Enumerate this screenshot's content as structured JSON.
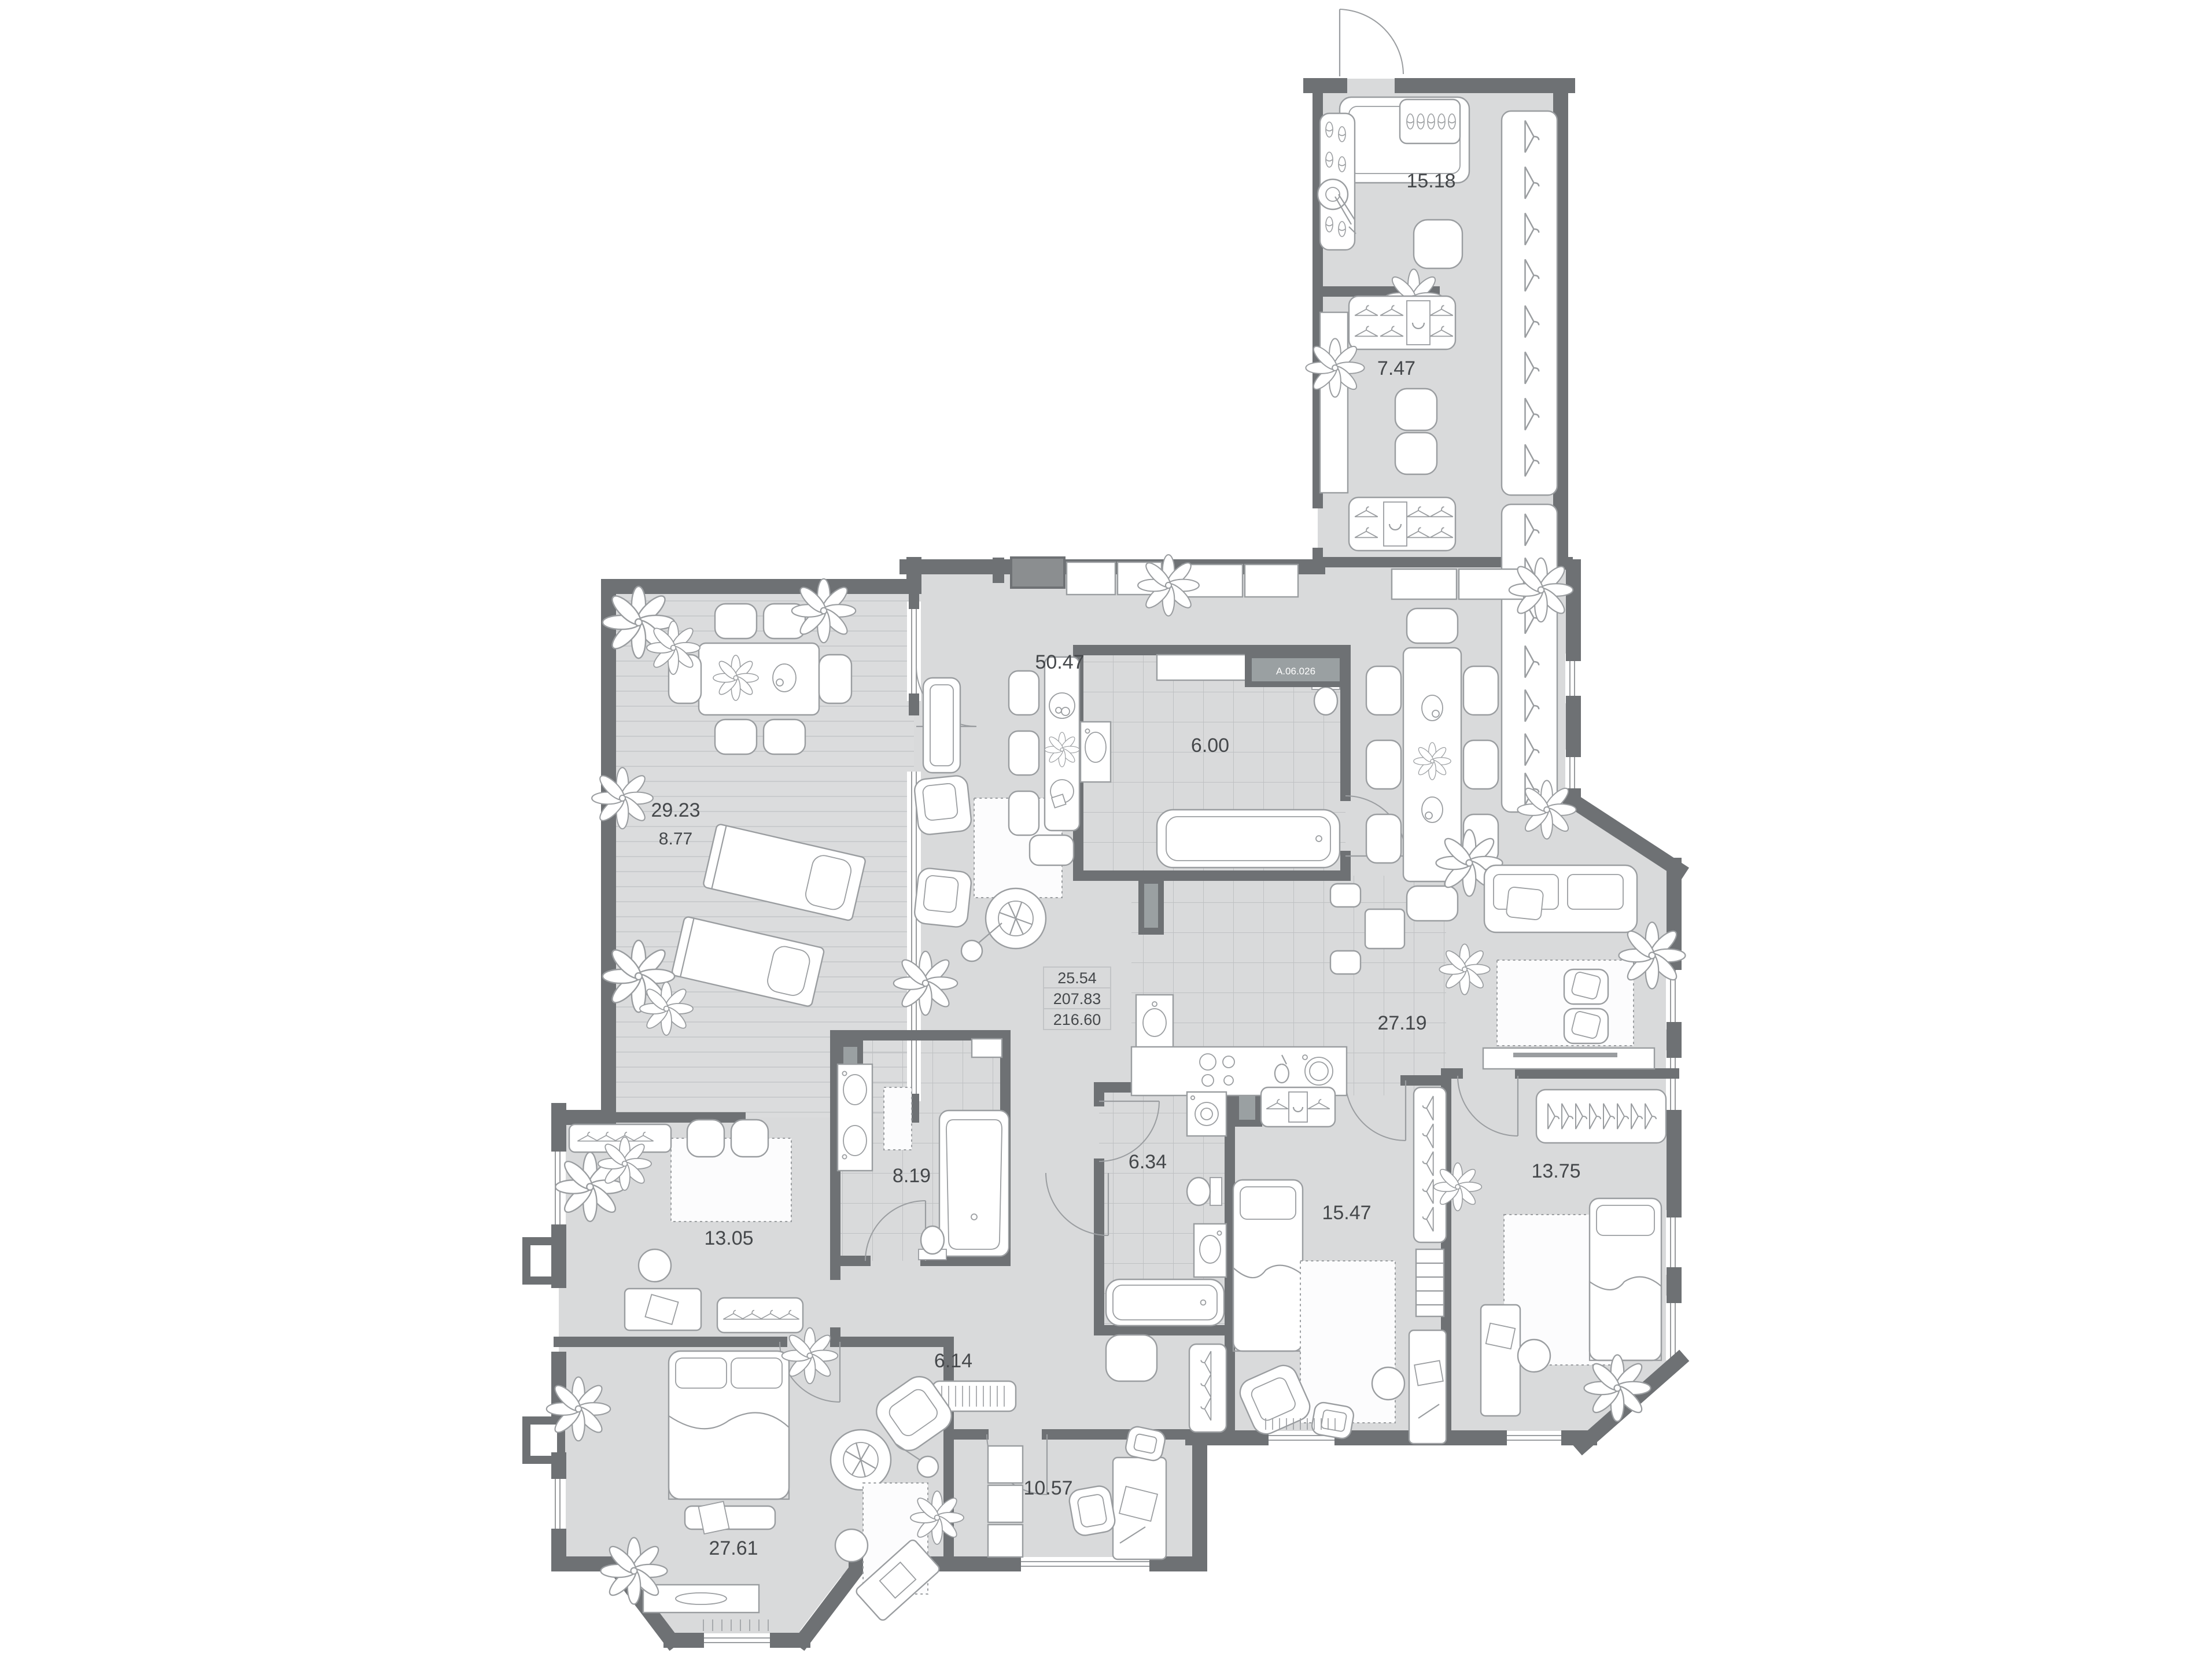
{
  "unit_badge": "A.06.026",
  "area_summary": {
    "row1": "25.54",
    "row2": "207.83",
    "row3": "216.60"
  },
  "rooms": {
    "entrance_hall": {
      "area": "15.18"
    },
    "wardrobe_hall": {
      "area": "7.47"
    },
    "living_dining": {
      "area": "50.47"
    },
    "bathroom_ensuite": {
      "area": "6.00"
    },
    "kitchen_lounge": {
      "area": "27.19"
    },
    "terrace": {
      "area_total": "29.23",
      "area_reduced": "8.77"
    },
    "bathroom_main": {
      "area": "8.19"
    },
    "dressing_room": {
      "area": "13.05"
    },
    "bathroom_guest": {
      "area": "6.34"
    },
    "bedroom_one": {
      "area": "15.47"
    },
    "bedroom_two": {
      "area": "13.75"
    },
    "hallway": {
      "area": "6.14"
    },
    "master_bedroom": {
      "area": "27.61"
    },
    "study": {
      "area": "10.57"
    }
  },
  "colors": {
    "wall": "#6e7174",
    "floor": "#d9dadb",
    "tile_line": "#bfc1c3",
    "deck_line": "#c9cbcd",
    "furniture_line": "#9a9da0",
    "label_text": "#45484b",
    "badge_bg": "#9aa0a2",
    "badge_text": "#ffffff"
  }
}
